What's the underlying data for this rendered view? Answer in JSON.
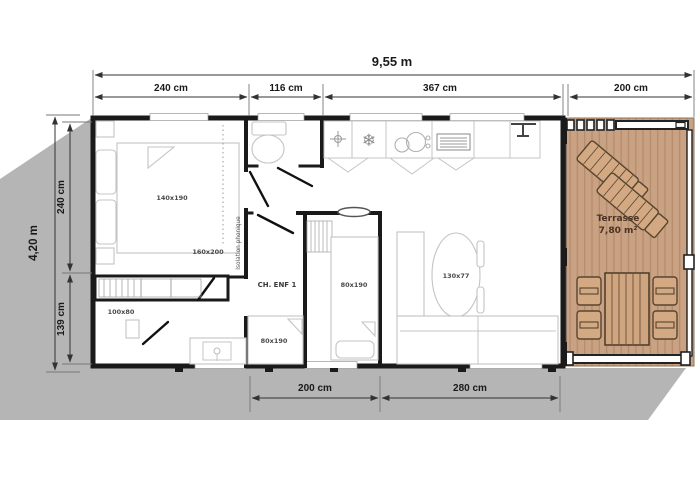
{
  "dims": {
    "total_width": "9,55 m",
    "total_height": "4,20 m",
    "top_segments": [
      "240 cm",
      "116 cm",
      "367 cm",
      "200 cm"
    ],
    "left_segments": [
      "240 cm",
      "139 cm"
    ],
    "bottom_segments": [
      "200 cm",
      "280 cm"
    ]
  },
  "labels": {
    "master_bed": "140x190",
    "master_bed_alt": "160x200",
    "shower_tray": "100x80",
    "child_room": "CH. ENF 1",
    "child_bed1": "80x190",
    "child_bed2": "80x190",
    "dining_table": "130x77",
    "terrace": "Terrasse",
    "terrace_area": "7,80 m²",
    "insulation_note": "Isolation phonique"
  },
  "colors": {
    "ground": "#b5b5b5",
    "wall": "#1a1a1a",
    "terrace_wood": "#c9a183",
    "terrace_wood_dark": "#b58c6c",
    "furniture_outline": "#c4c4c4",
    "terrace_text": "#4a3325"
  }
}
